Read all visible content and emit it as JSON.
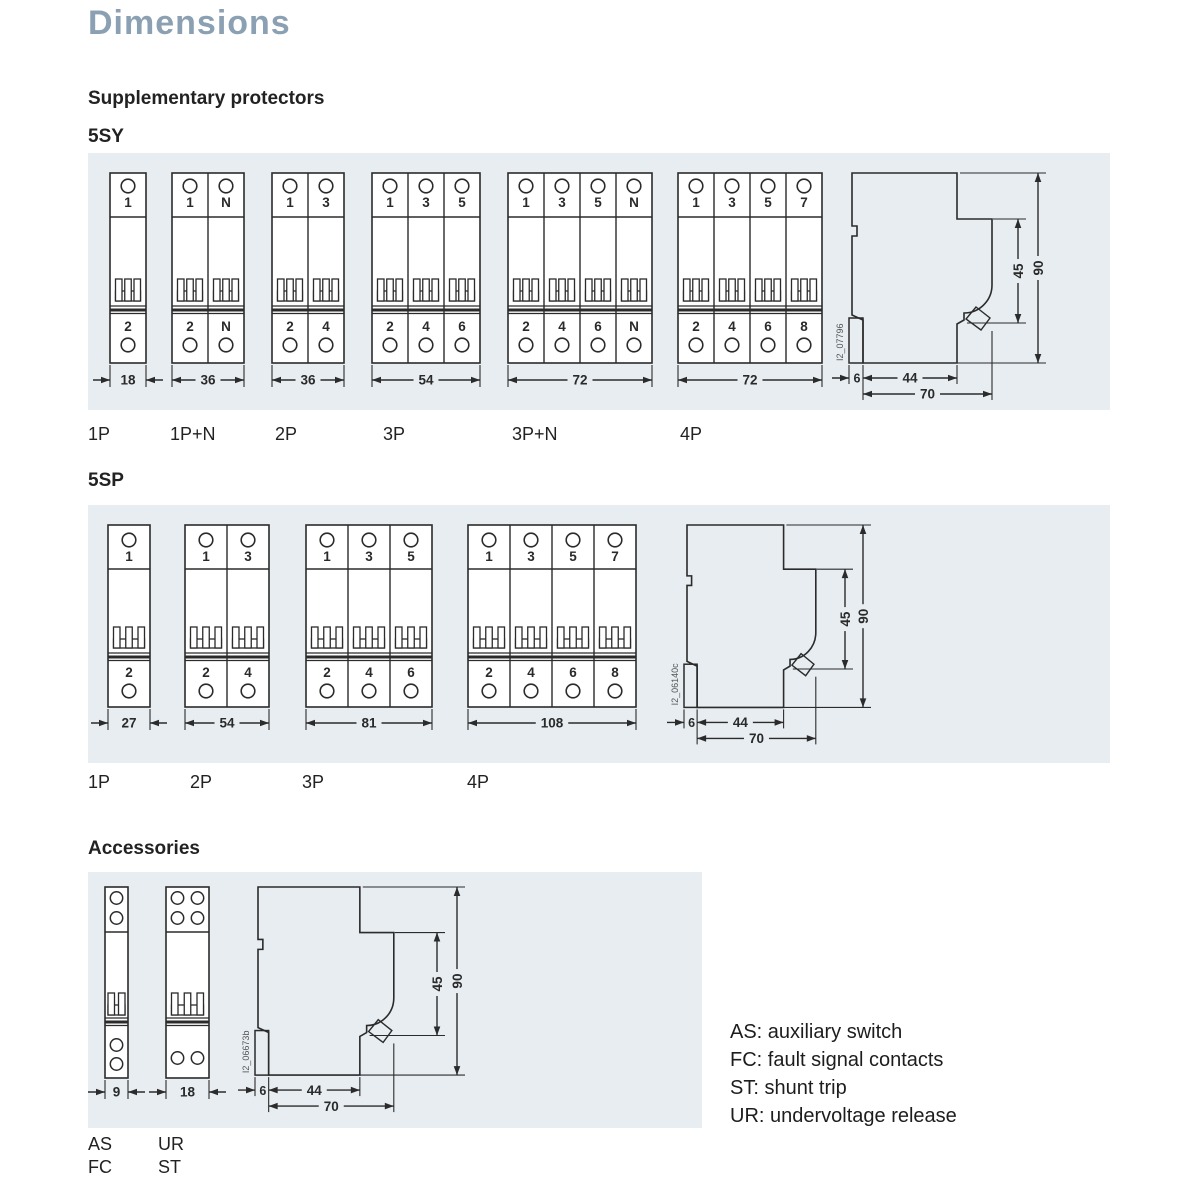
{
  "page": {
    "title": "Dimensions",
    "section_supplementary": "Supplementary protectors",
    "series_5sy": "5SY",
    "series_5sp": "5SP",
    "section_accessories": "Accessories"
  },
  "colors": {
    "title": "#8ba1b3",
    "panel_bg": "#e7edf1",
    "line": "#2b2b2b",
    "text": "#1d1d1d"
  },
  "sy5": {
    "breakers": [
      {
        "label": "1P",
        "top": [
          "1"
        ],
        "bottom": [
          "2"
        ],
        "width_mm": "18"
      },
      {
        "label": "1P+N",
        "top": [
          "1",
          "N"
        ],
        "bottom": [
          "2",
          "N"
        ],
        "width_mm": "36"
      },
      {
        "label": "2P",
        "top": [
          "1",
          "3"
        ],
        "bottom": [
          "2",
          "4"
        ],
        "width_mm": "36"
      },
      {
        "label": "3P",
        "top": [
          "1",
          "3",
          "5"
        ],
        "bottom": [
          "2",
          "4",
          "6"
        ],
        "width_mm": "54"
      },
      {
        "label": "3P+N",
        "top": [
          "1",
          "3",
          "5",
          "N"
        ],
        "bottom": [
          "2",
          "4",
          "6",
          "N"
        ],
        "width_mm": "72"
      },
      {
        "label": "4P",
        "top": [
          "1",
          "3",
          "5",
          "7"
        ],
        "bottom": [
          "2",
          "4",
          "6",
          "8"
        ],
        "width_mm": "72"
      }
    ],
    "side": {
      "id_code": "I2_07796",
      "height_mm": "90",
      "front_section_mm": "45",
      "rail_offset_mm": "6",
      "body_depth_mm": "44",
      "total_depth_mm": "70"
    }
  },
  "sp5": {
    "breakers": [
      {
        "label": "1P",
        "top": [
          "1"
        ],
        "bottom": [
          "2"
        ],
        "width_mm": "27"
      },
      {
        "label": "2P",
        "top": [
          "1",
          "3"
        ],
        "bottom": [
          "2",
          "4"
        ],
        "width_mm": "54"
      },
      {
        "label": "3P",
        "top": [
          "1",
          "3",
          "5"
        ],
        "bottom": [
          "2",
          "4",
          "6"
        ],
        "width_mm": "81"
      },
      {
        "label": "4P",
        "top": [
          "1",
          "3",
          "5",
          "7"
        ],
        "bottom": [
          "2",
          "4",
          "6",
          "8"
        ],
        "width_mm": "108"
      }
    ],
    "side": {
      "id_code": "I2_06140c",
      "height_mm": "90",
      "front_section_mm": "45",
      "rail_offset_mm": "6",
      "body_depth_mm": "44",
      "total_depth_mm": "70"
    }
  },
  "accessories": {
    "devices": [
      {
        "labels": [
          "AS",
          "FC"
        ],
        "width_mm": "9"
      },
      {
        "labels": [
          "UR",
          "ST"
        ],
        "width_mm": "18"
      }
    ],
    "side": {
      "id_code": "I2_06673b",
      "height_mm": "90",
      "front_section_mm": "45",
      "rail_offset_mm": "6",
      "body_depth_mm": "44",
      "total_depth_mm": "70"
    },
    "legend": [
      "AS: auxiliary switch",
      "FC: fault signal contacts",
      "ST: shunt trip",
      "UR: undervoltage release"
    ]
  }
}
